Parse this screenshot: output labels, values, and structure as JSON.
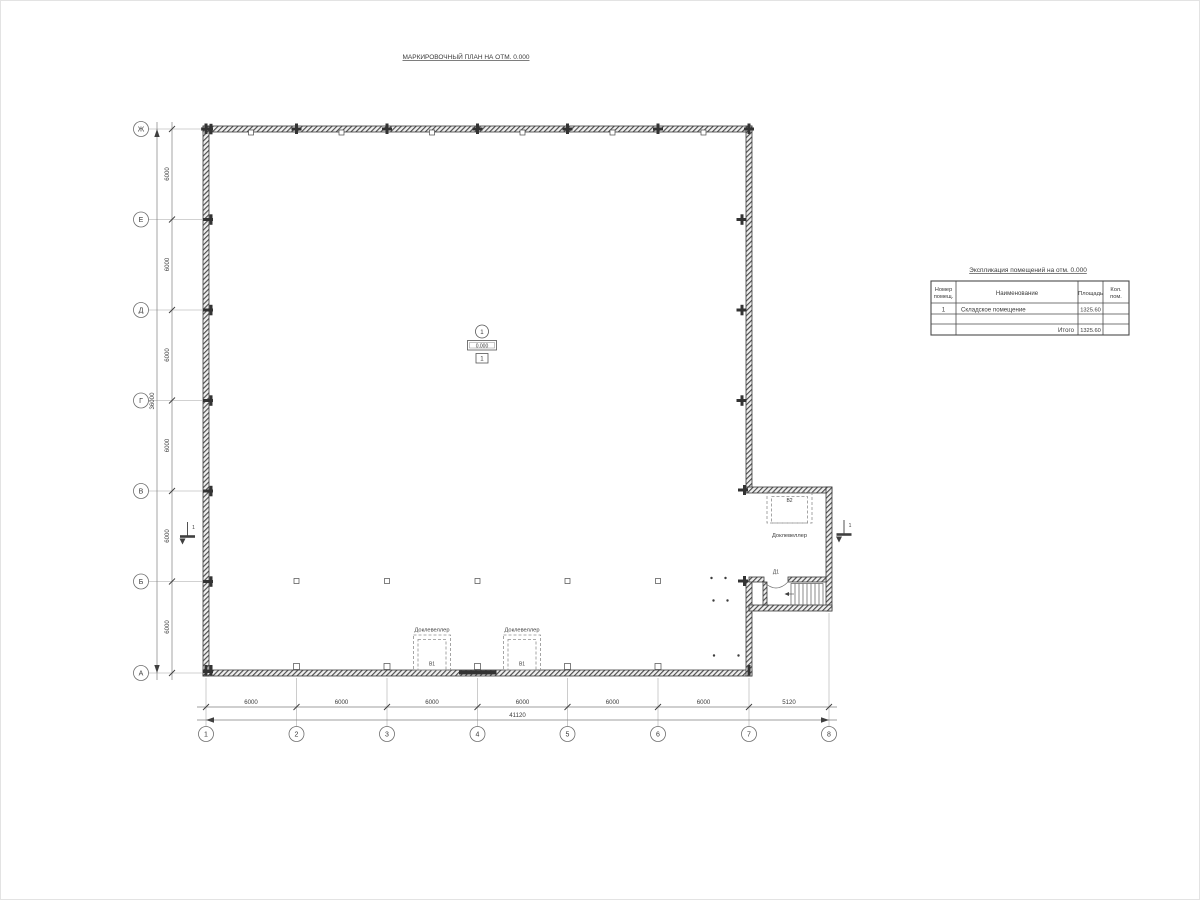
{
  "page": {
    "title": "МАРКИРОВОЧНЫЙ ПЛАН НА ОТМ. 0.000"
  },
  "colors": {
    "line": "#3a3a3a",
    "dim_line": "#7f7f7f",
    "text": "#3a3a3a"
  },
  "axes": {
    "cols": [
      "1",
      "2",
      "3",
      "4",
      "5",
      "6",
      "7",
      "8"
    ],
    "rows": [
      "Ж",
      "Е",
      "Д",
      "Г",
      "В",
      "Б",
      "А"
    ]
  },
  "dims": {
    "bottom_bays": [
      "6000",
      "6000",
      "6000",
      "6000",
      "6000",
      "6000",
      "5120"
    ],
    "bottom_total": "41120",
    "left_bays": [
      "6000",
      "6000",
      "6000",
      "6000",
      "6000",
      "6000"
    ],
    "left_total": "36000"
  },
  "plan": {
    "room_number": "1",
    "elevation": "0.000",
    "level_tag": "1",
    "section_label": "1",
    "dock_text": "Доклевеллер",
    "dock_tags": [
      "В1",
      "В1",
      "В2"
    ],
    "door_tag": "Д1"
  },
  "schedule": {
    "title": "Экспликация помещений на отм. 0.000",
    "headers": {
      "num_line1": "Номер",
      "num_line2": "помещ.",
      "name": "Наименование",
      "area": "Площадь",
      "count_line1": "Кол.",
      "count_line2": "пом."
    },
    "rows": [
      {
        "num": "1",
        "name": "Складское помещение",
        "area": "1325.60",
        "count": ""
      },
      {
        "num": "",
        "name": "",
        "area": "",
        "count": ""
      },
      {
        "num": "",
        "name": "Итого",
        "area": "1325.60",
        "count": ""
      }
    ]
  }
}
